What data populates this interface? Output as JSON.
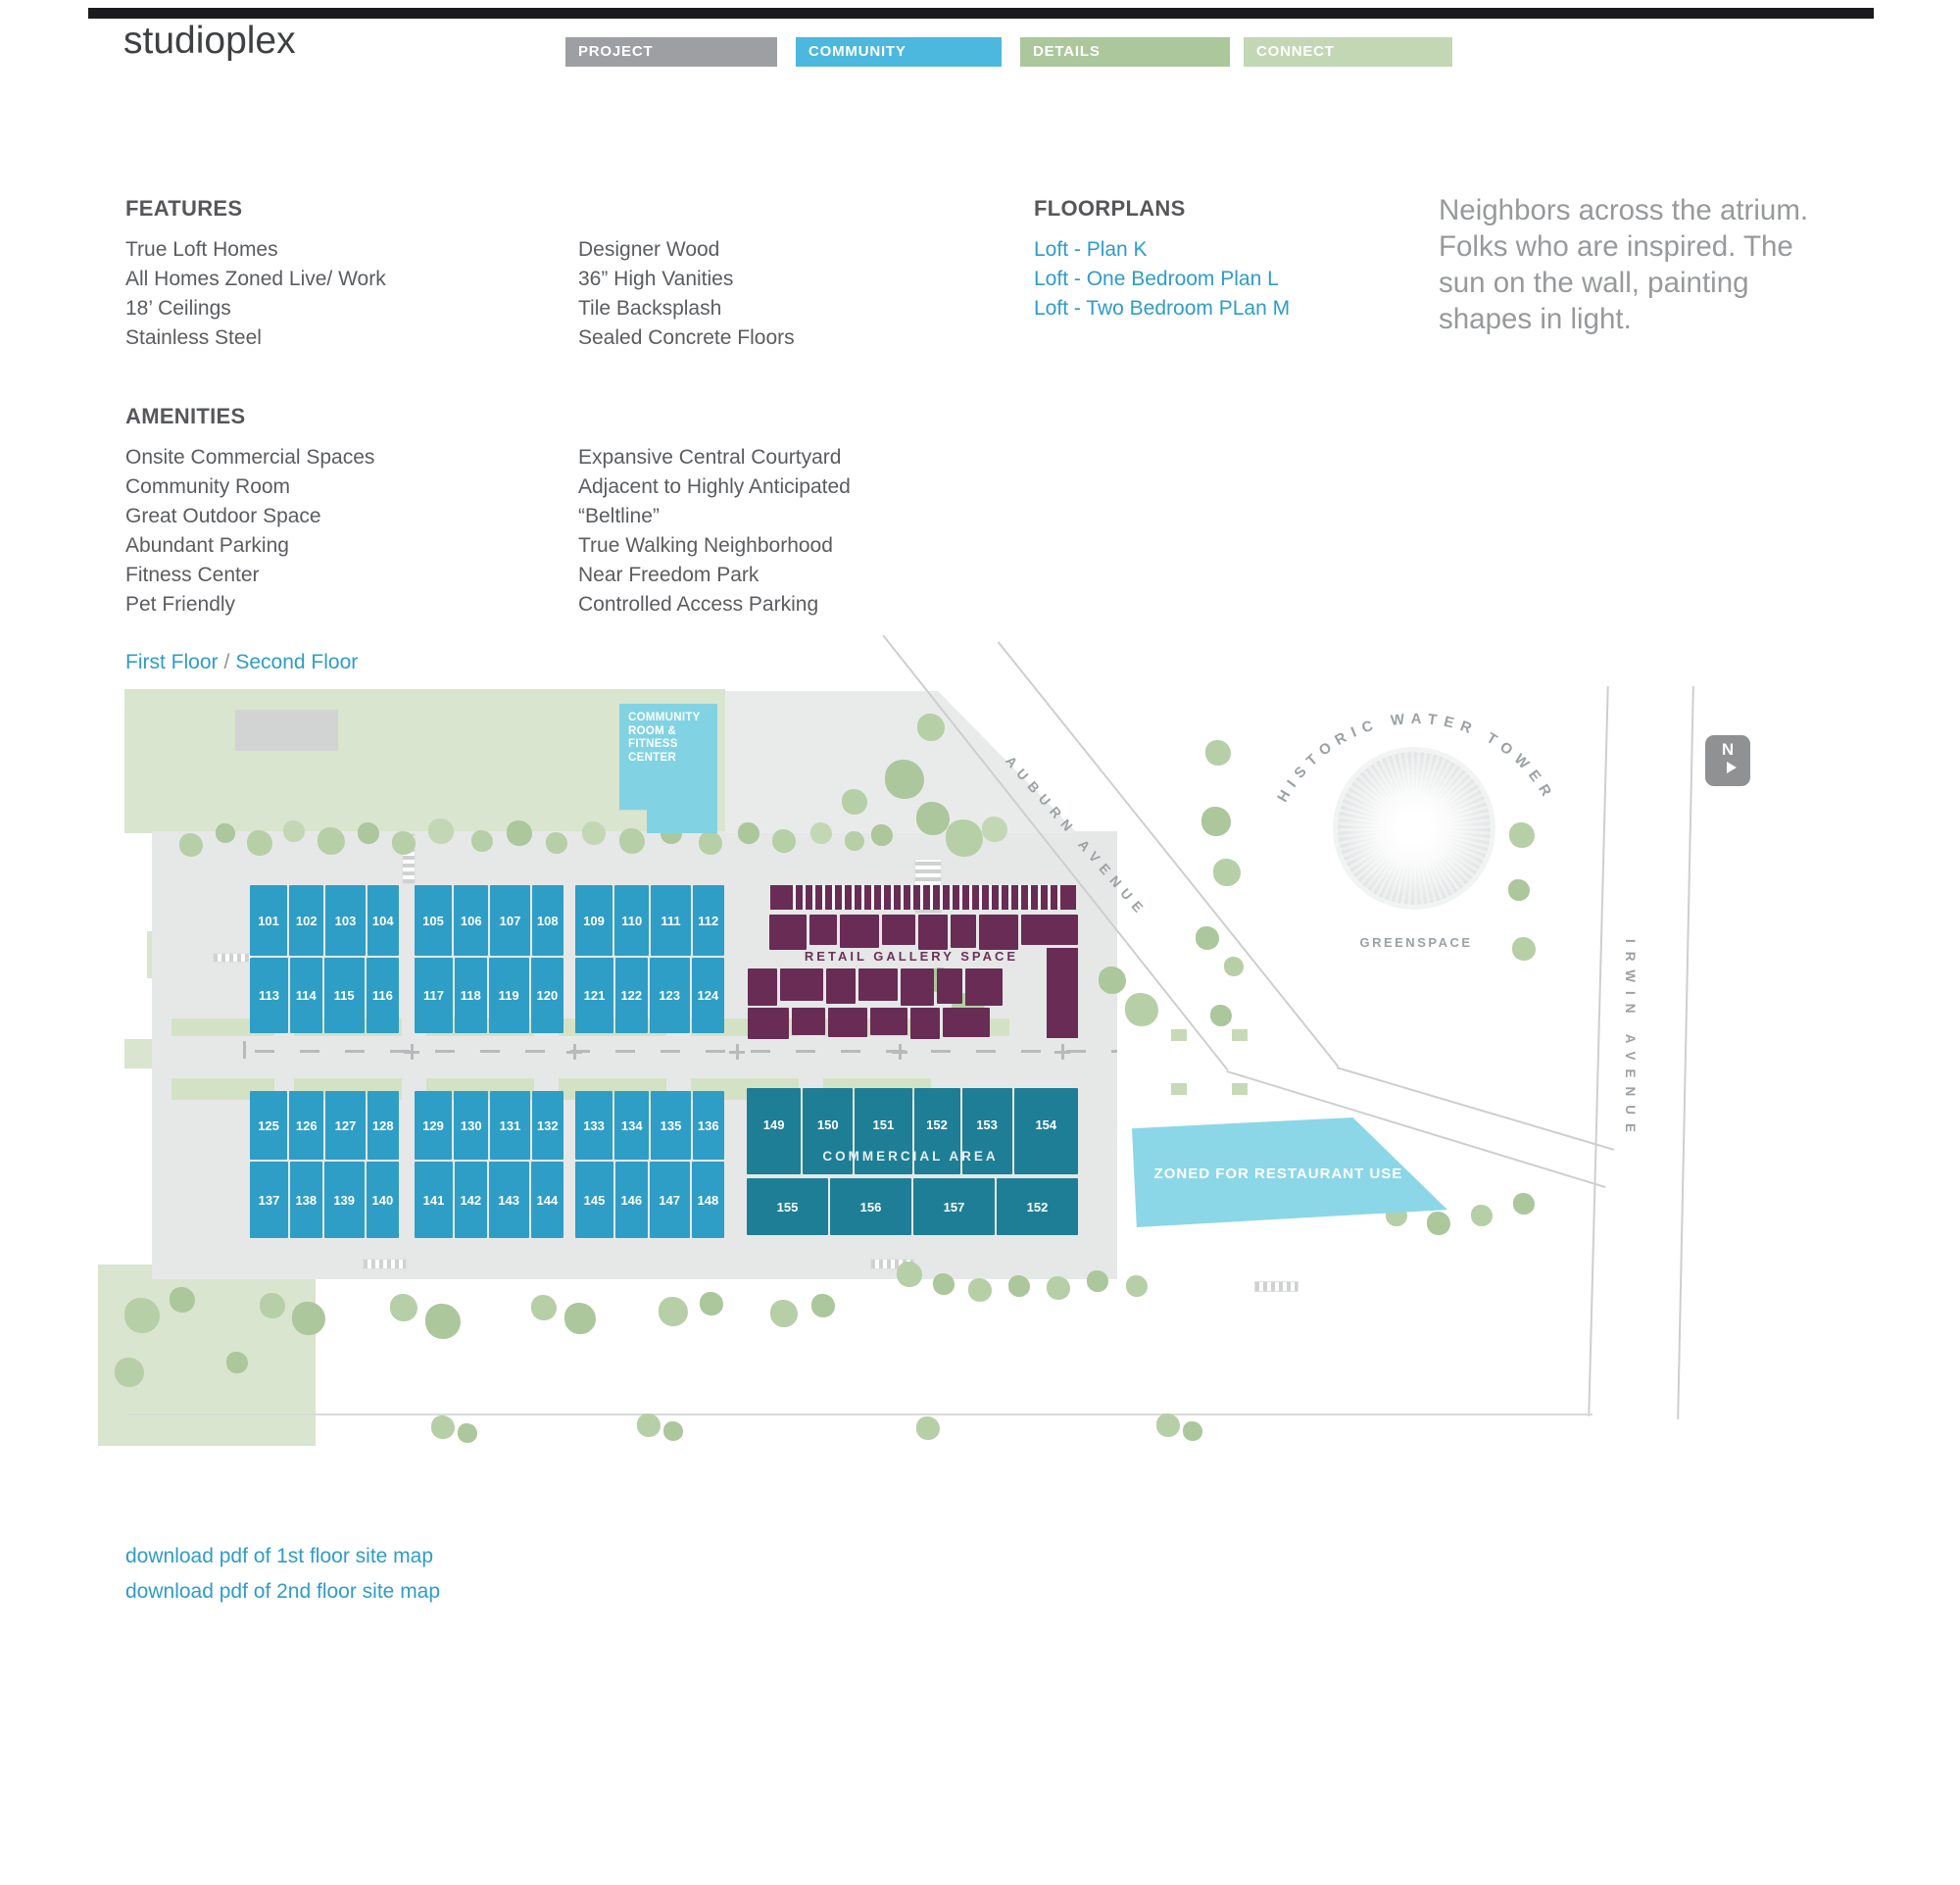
{
  "header": {
    "logo": "studioplex",
    "tabs": [
      "PROJECT",
      "COMMUNITY",
      "DETAILS",
      "CONNECT"
    ],
    "active_tab": "COMMUNITY"
  },
  "features": {
    "heading": "FEATURES",
    "col1": [
      "True Loft Homes",
      "All Homes Zoned Live/ Work",
      "18’ Ceilings",
      "Stainless Steel"
    ],
    "col2": [
      "Designer Wood",
      "36” High Vanities",
      "Tile Backsplash",
      "Sealed Concrete Floors"
    ]
  },
  "amenities": {
    "heading": "AMENITIES",
    "col1": [
      "Onsite Commercial Spaces",
      "Community Room",
      "Great Outdoor Space",
      "Abundant Parking",
      "Fitness Center",
      "Pet Friendly"
    ],
    "col2": [
      "Expansive Central Courtyard",
      "Adjacent to Highly Anticipated",
      "“Beltline”",
      "True Walking Neighborhood",
      "Near Freedom Park",
      "Controlled Access Parking"
    ]
  },
  "floorplans": {
    "heading": "FLOORPLANS",
    "links": [
      "Loft - Plan K",
      "Loft - One Bedroom Plan L",
      "Loft - Two Bedroom PLan M"
    ]
  },
  "quote": "Neighbors across the atrium. Folks who are inspired. The sun on the wall, painting shapes in light.",
  "floor_selector": {
    "options": [
      "First Floor",
      "Second Floor"
    ],
    "separator": "/"
  },
  "map": {
    "community_room_label": "COMMUNITY ROOM & FITNESS CENTER",
    "retail_label": "RETAIL GALLERY SPACE",
    "commercial_label": "COMMERCIAL AREA",
    "restaurant_label": "ZONED FOR RESTAURANT USE",
    "water_tower_label": "HISTORIC WATER TOWER",
    "greenspace_label": "GREENSPACE",
    "auburn_label": "AUBURN AVENUE",
    "irwin_label": "IRWIN AVENUE",
    "north_label": "N",
    "lofts": [
      {
        "top": [
          "101",
          "102",
          "103",
          "104"
        ],
        "bottom": [
          "113",
          "114",
          "115",
          "116"
        ]
      },
      {
        "top": [
          "105",
          "106",
          "107",
          "108"
        ],
        "bottom": [
          "117",
          "118",
          "119",
          "120"
        ]
      },
      {
        "top": [
          "109",
          "110",
          "111",
          "112"
        ],
        "bottom": [
          "121",
          "122",
          "123",
          "124"
        ]
      },
      {
        "top": [
          "125",
          "126",
          "127",
          "128"
        ],
        "bottom": [
          "137",
          "138",
          "139",
          "140"
        ]
      },
      {
        "top": [
          "129",
          "130",
          "131",
          "132"
        ],
        "bottom": [
          "141",
          "142",
          "143",
          "144"
        ]
      },
      {
        "top": [
          "133",
          "134",
          "135",
          "136"
        ],
        "bottom": [
          "145",
          "146",
          "147",
          "148"
        ]
      }
    ],
    "commercial": {
      "top": [
        "149",
        "150",
        "151",
        "152",
        "153",
        "154"
      ],
      "bottom": [
        "155",
        "156",
        "157",
        "152"
      ]
    }
  },
  "downloads": [
    "download pdf of 1st floor site map",
    "download pdf of 2nd floor site map"
  ],
  "colors": {
    "tab_active": "#4cb8dd",
    "tab_inactive": "#9d9fa2",
    "link_blue": "#2f9cc9",
    "loft_unit_blue": "#2e9ec6",
    "commercial_teal": "#1e7e96",
    "retail_purple": "#682c55",
    "community_room_cyan": "#81d3e3",
    "restaurant_cyan": "#8bd7e8",
    "map_green": "#d9e5ce",
    "tree_green": "#b3cca4",
    "map_label_gray": "#9ba1a4"
  }
}
